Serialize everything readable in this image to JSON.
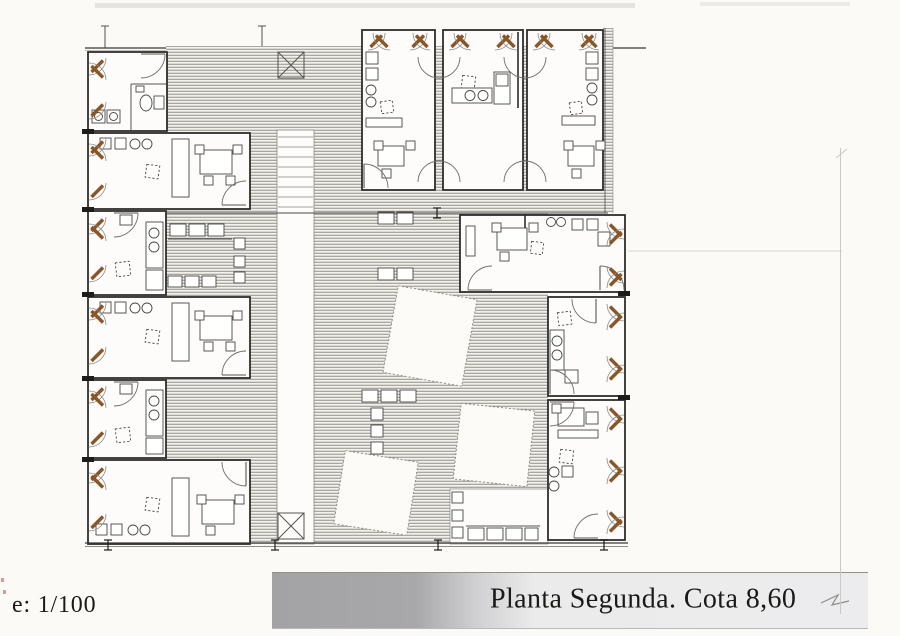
{
  "document": {
    "title": "Planta Segunda. Cota 8,60",
    "scale_label": "e: 1/100"
  },
  "colors": {
    "paper": "#fbfaf7",
    "ink": "#2e2d2b",
    "shutter": "#8a5527",
    "bar_left": "#a3a2a4",
    "bar_right": "#ebebec",
    "text": "#1b1a18"
  }
}
